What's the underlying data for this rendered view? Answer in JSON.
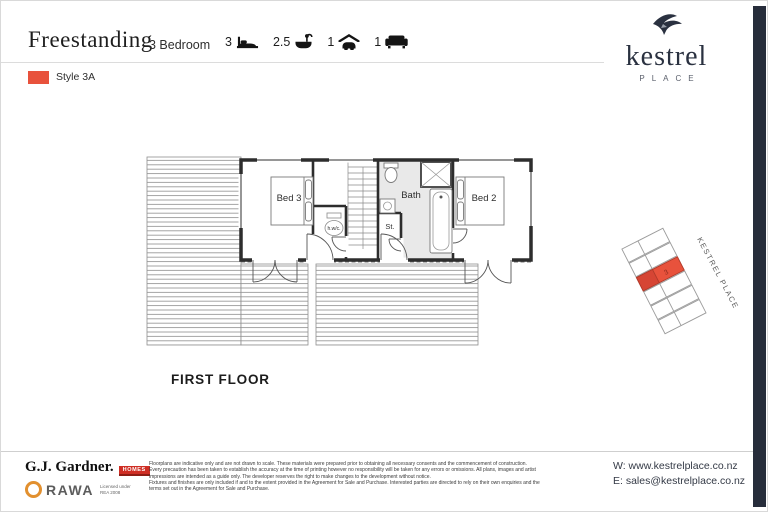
{
  "header": {
    "title": "Freestanding",
    "bedrooms": "3 Bedroom",
    "specs": [
      {
        "count": "3",
        "icon": "bed-icon"
      },
      {
        "count": "2.5",
        "icon": "bath-icon"
      },
      {
        "count": "1",
        "icon": "garage-icon"
      },
      {
        "count": "1",
        "icon": "living-icon"
      }
    ],
    "style": {
      "label": "Style 3A",
      "color": "#e8523c"
    }
  },
  "brand": {
    "name": "kestrel",
    "tagline": "PLACE"
  },
  "floorplan": {
    "title": "FIRST FLOOR",
    "rooms": {
      "bed3": "Bed 3",
      "bed2": "Bed 2",
      "bath": "Bath",
      "store": "St.",
      "wc": "h.w/c."
    }
  },
  "sitemap": {
    "street_label": "KESTREL PLACE",
    "lot_number": "3",
    "highlight_color": "#e8523c"
  },
  "footer": {
    "builder_name": "G.J. Gardner.",
    "builder_badge": "HOMES",
    "agency_name": "RAWA",
    "agency_license": "Licensed under\nREA 2008",
    "disclaimer": "Floorplans are indicative only and are not drawn to scale. These materials were prepared prior to obtaining all necessary consents and the commencement of construction.\nEvery precaution has been taken to establish the accuracy at the time of printing however no responsibility will be taken for any errors or omissions. All plans, images and artist\nimpressions are intended as a guide only. The developer reserves the right to make changes to the development without notice.\nFixtures and finishes are only included if and to the extent provided in the Agreement for Sale and Purchase. Interested parties are directed to rely on their own enquiries and the\nterms set out in the Agreement for Sale and Purchase.",
    "website": "W: www.kestrelplace.co.nz",
    "email": "E: sales@kestrelplace.co.nz"
  }
}
